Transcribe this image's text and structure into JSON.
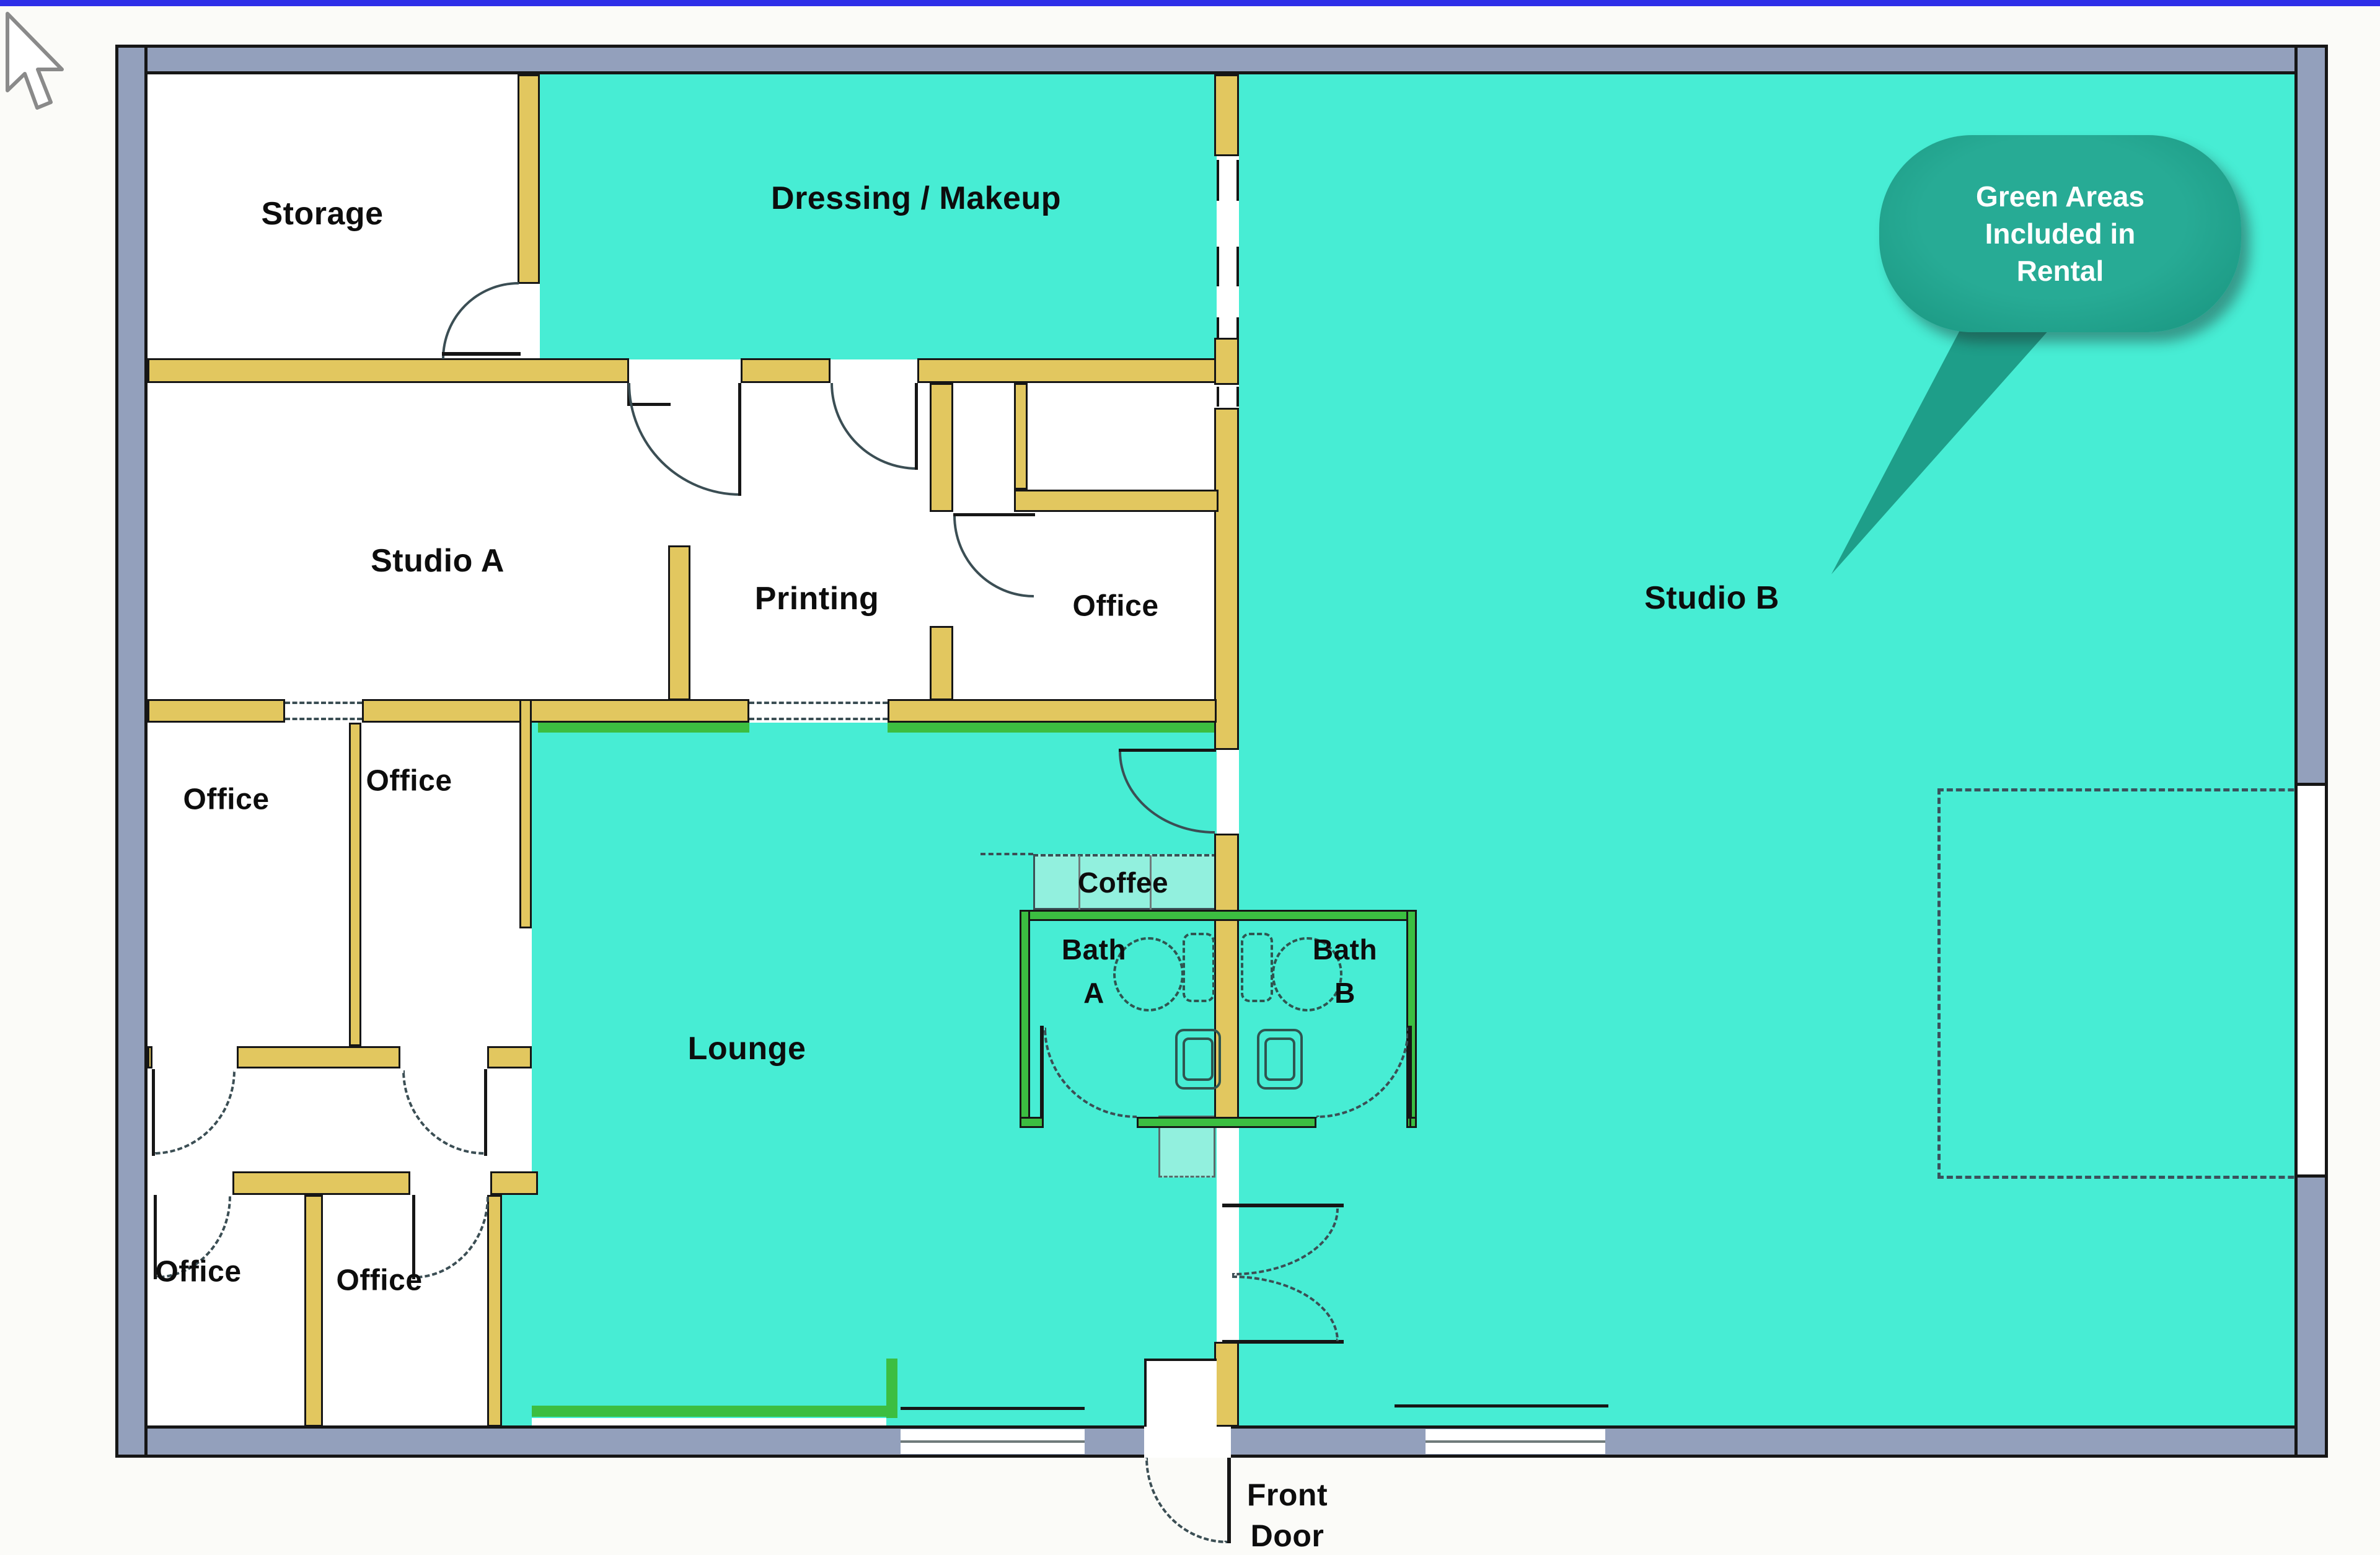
{
  "window": {
    "top_border_color": "#2E2FE8"
  },
  "floor_plan": {
    "rooms": {
      "storage": "Storage",
      "dressing_makeup": "Dressing / Makeup",
      "studio_a": "Studio A",
      "printing": "Printing",
      "office": "Office",
      "studio_b": "Studio B",
      "lounge": "Lounge",
      "coffee": "Coffee",
      "bath": "Bath",
      "bath_a_letter": "A",
      "bath_b_letter": "B"
    },
    "front_door": {
      "line1": "Front",
      "line2": "Door"
    },
    "callout": {
      "line1": "Green Areas",
      "line2": "Included in",
      "line3": "Rental"
    },
    "colors": {
      "floor_teal": "#47EDD4",
      "counter_teal": "#92F0DE",
      "wall_yellow": "#E2C75F",
      "wall_green": "#3CBE41",
      "outer_wall_gray": "#93A0BC",
      "line_black": "#161616",
      "callout_teal": "#1FA38D",
      "callout_text": "#FFFFFF",
      "top_border_blue": "#2E2FE8",
      "label_color": "#0D0D0D"
    }
  }
}
